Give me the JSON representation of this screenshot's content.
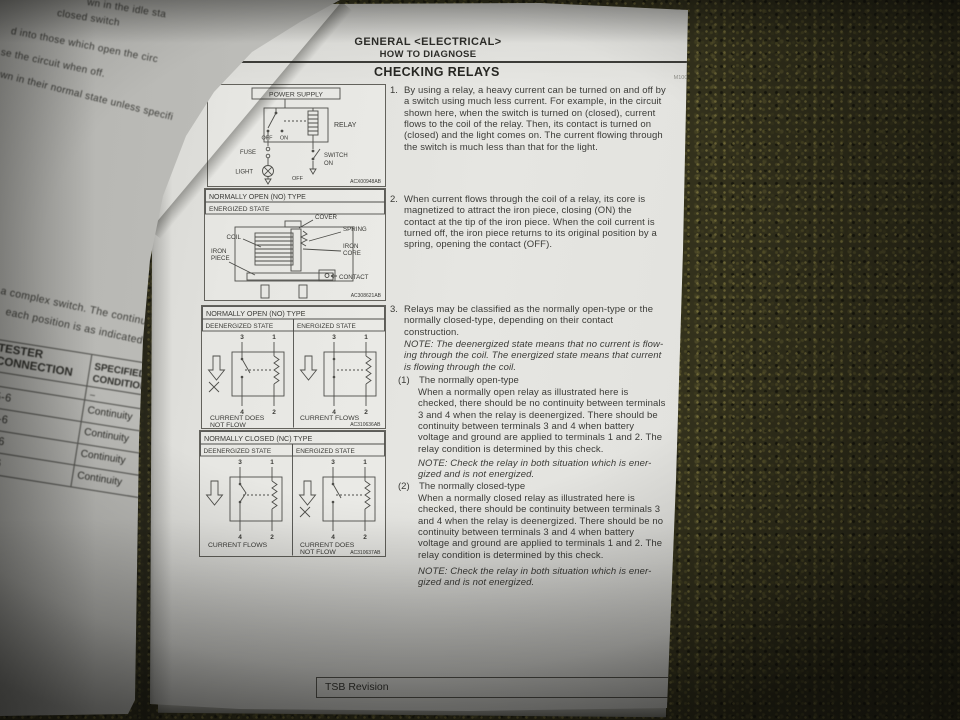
{
  "colors": {
    "carpet": "#33311c",
    "paper": "#e3e3df"
  },
  "right_page": {
    "header": {
      "section_title": "GENERAL <ELECTRICAL>",
      "subsection_title": "HOW TO DIAGNOSE",
      "page_number": "00E-11"
    },
    "section_heading": "CHECKING RELAYS",
    "doc_code": "M1001004900152",
    "items": [
      {
        "num": "1.",
        "lines": [
          "By using a relay, a heavy current can be turned on and off by",
          "a switch using much less current. For example, in the circuit",
          "shown here, when the switch is turned on (closed), current",
          "flows to the coil of the relay. Then, its contact is turned on",
          "(closed) and the light comes on. The current flowing through",
          "the switch is much less than that for the light."
        ]
      },
      {
        "num": "2.",
        "lines": [
          "When current flows through the coil of a relay, its core is",
          "magnetized to attract the iron piece, closing (ON) the",
          "contact at the tip of the iron piece. When the coil current is",
          "turned off, the iron piece returns to its original position by a",
          "spring, opening the contact (OFF)."
        ]
      },
      {
        "num": "3.",
        "lines": [
          "Relays may be classified as the normally open-type or the",
          "normally closed-type, depending on their contact",
          "construction."
        ]
      }
    ],
    "note1_lines": [
      "NOTE: The deenergized state means that no current is flow-",
      "ing through the coil. The energized state means that current",
      "is flowing through the coil."
    ],
    "sub_items": [
      {
        "num": "(1)",
        "title": "The normally open-type",
        "lines": [
          "When a normally open relay as illustrated here is",
          "checked, there should be no continuity between terminals",
          "3 and 4 when the relay is deenergized. There should be",
          "continuity between terminals 3 and 4 when battery",
          "voltage and ground are applied to terminals 1 and 2. The",
          "relay condition is determined by this check."
        ]
      },
      {
        "num": "(2)",
        "title": "The normally closed-type",
        "lines": [
          "When a normally closed relay as illustrated here is",
          "checked, there should be continuity between terminals 3",
          "and 4 when the relay is deenergized. There should be no",
          "continuity between terminals 3 and 4 when battery",
          "voltage and ground are applied to terminals 1 and 2. The",
          "relay condition is determined by this check."
        ]
      }
    ],
    "note_check_lines": [
      "NOTE: Check the relay in both situation which is ener-",
      "gized and is not energized."
    ],
    "footer_label": "TSB Revision"
  },
  "diagrams": {
    "circuit": {
      "power_supply": "POWER SUPPLY",
      "relay": "RELAY",
      "off": "OFF",
      "on": "ON",
      "fuse": "FUSE",
      "switch": "SWITCH",
      "switch_on": "ON",
      "light": "LIGHT",
      "off2": "OFF",
      "code": "ACX00948AB"
    },
    "structure": {
      "title": "NORMALLY OPEN (NO) TYPE",
      "state": "ENERGIZED STATE",
      "cover": "COVER",
      "spring": "SPRING",
      "coil": "COIL",
      "iron1": "IRON",
      "core": "CORE",
      "iron2": "IRON",
      "piece": "PIECE",
      "contact": "CONTACT",
      "code": "AC308621AB"
    },
    "no_type": {
      "title": "NORMALLY OPEN (NO) TYPE",
      "left_state": "DEENERGIZED STATE",
      "right_state": "ENERGIZED STATE",
      "left_cap1": "CURRENT DOES",
      "left_cap2": "NOT FLOW",
      "right_cap": "CURRENT FLOWS",
      "code": "AC310636AB"
    },
    "nc_type": {
      "title": "NORMALLY CLOSED (NC) TYPE",
      "left_state": "DEENERGIZED STATE",
      "right_state": "ENERGIZED STATE",
      "left_cap": "CURRENT FLOWS",
      "right_cap1": "CURRENT DOES",
      "right_cap2": "NOT FLOW",
      "code": "AC310637AB"
    },
    "terminals": {
      "t3": "3",
      "t1": "1",
      "t4": "4",
      "t2": "2"
    }
  },
  "left_page": {
    "fragments_top": [
      "wn in the idle sta",
      "closed switch",
      "d into those which open the circ",
      "se the circuit when off.",
      "own in their normal state unless specifi"
    ],
    "fragments_mid": [
      "a complex switch. The continuity",
      "each position is as indicated in the"
    ],
    "table": {
      "header_col1_line1": "TESTER",
      "header_col1_line2": "CONNECTION",
      "header_col2_line1": "SPECIFIED",
      "header_col2_line2": "CONDITION",
      "dash": "–",
      "rows": [
        {
          "connection": "-5-6",
          "condition": "Continuity"
        },
        {
          "connection": "-4-6",
          "condition": "Continuity"
        },
        {
          "connection": "-3-6",
          "condition": "Continuity"
        },
        {
          "connection": "-2-6",
          "condition": "Continuity"
        }
      ]
    }
  }
}
